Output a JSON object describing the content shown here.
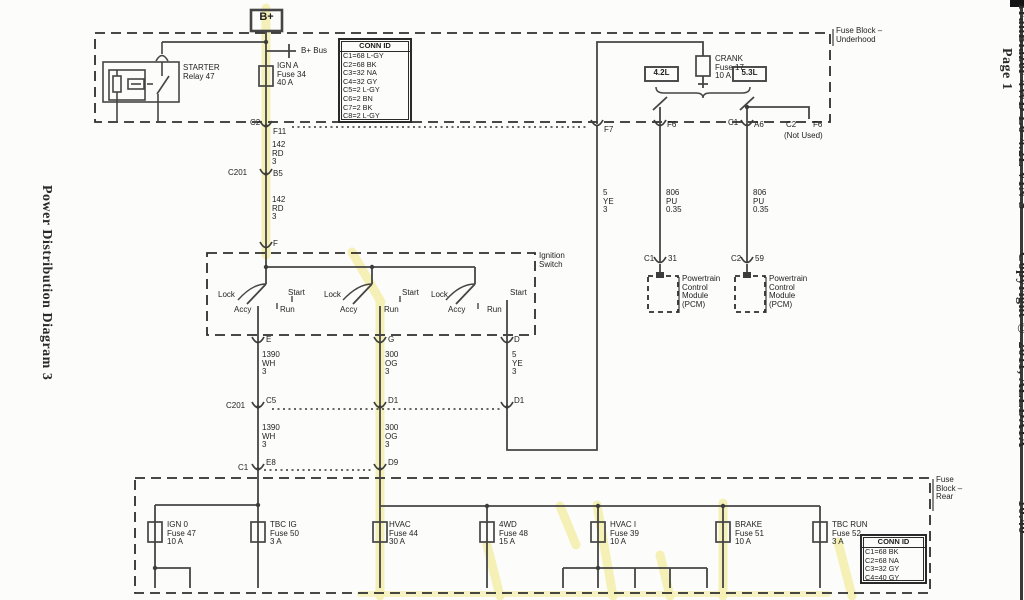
{
  "page": {
    "left_title": "Power Distribution Diagram 3",
    "right_vehicle": "TrailBlazer 4WD L6-4.2L VIN S",
    "right_copyright": "Copyright © 2011, ALLDATA",
    "right_version": "10.40",
    "right_page": "Page 1"
  },
  "underhood": {
    "block_label": "Fuse Block –\nUnderhood",
    "b_plus": "B+",
    "b_plus_bus": "B+ Bus",
    "starter_relay": "STARTER\nRelay 47",
    "ign_a_fuse": "IGN A\nFuse 34\n40 A",
    "crank_fuse": "CRANK\nFuse 17\n10 A",
    "engine_a": "4.2L",
    "engine_b": "5.3L",
    "conn_id": {
      "title": "CONN ID",
      "rows": [
        "C1=68 L-GY",
        "C2=68 BK",
        "C3=32 NA",
        "C4=32 GY",
        "C5=2 L-GY",
        "C6=2 BN",
        "C7=2 BK",
        "C8=2 L-GY"
      ]
    },
    "connectors": {
      "c2": "C2",
      "f11": "F11",
      "f7": "F7",
      "f6": "F6",
      "c1": "C1",
      "a6": "A6",
      "c2_2": "C2",
      "f6_2": "F6",
      "not_used": "(Not Used)"
    }
  },
  "wires": {
    "w142_a": "142\nRD\n3",
    "w142_b": "142\nRD\n3",
    "w5ye_f7": "5\nYE\n3",
    "w806_a": "806\nPU\n0.35",
    "w806_b": "806\nPU\n0.35",
    "w1390_a": "1390\nWH\n3",
    "w1390_b": "1390\nWH\n3",
    "w300_a": "300\nOG\n3",
    "w300_b": "300\nOG\n3",
    "w5ye_d": "5\nYE\n3"
  },
  "connectors": {
    "c201": "C201",
    "b5": "B5",
    "f": "F",
    "e": "E",
    "g": "G",
    "d": "D",
    "c201_2": "C201",
    "c5": "C5",
    "d1_a": "D1",
    "d1_b": "D1",
    "c1_rear": "C1",
    "e8": "E8",
    "d9": "D9"
  },
  "ignition": {
    "block_label": "Ignition\nSwitch",
    "groups": [
      {
        "lock": "Lock",
        "start": "Start",
        "accy": "Accy",
        "run": "Run"
      },
      {
        "lock": "Lock",
        "start": "Start",
        "accy": "Accy",
        "run": "Run"
      },
      {
        "lock": "Lock",
        "start": "Start",
        "accy": "Accy",
        "run": "Run"
      }
    ]
  },
  "pcm": {
    "left": {
      "conn": "C1",
      "pin": "31",
      "label": "Powertrain\nControl\nModule\n(PCM)"
    },
    "right": {
      "conn": "C2",
      "pin": "59",
      "label": "Powertrain\nControl\nModule\n(PCM)"
    }
  },
  "rear": {
    "block_label": "Fuse\nBlock –\nRear",
    "fuses": [
      {
        "label": "IGN 0\nFuse 47\n10 A"
      },
      {
        "label": "TBC IG\nFuse 50\n3 A"
      },
      {
        "label": "HVAC\nFuse 44\n30 A"
      },
      {
        "label": "4WD\nFuse 48\n15 A"
      },
      {
        "label": "HVAC I\nFuse 39\n10 A"
      },
      {
        "label": "BRAKE\nFuse 51\n10 A"
      },
      {
        "label": "TBC RUN\nFuse 52\n3 A"
      }
    ],
    "conn_id": {
      "title": "CONN ID",
      "rows": [
        "C1=68 BK",
        "C2=68 NA",
        "C3=32 GY",
        "C4=40 GY"
      ]
    }
  },
  "colors": {
    "wire": "#454545",
    "highlight": "#f3eda0"
  }
}
